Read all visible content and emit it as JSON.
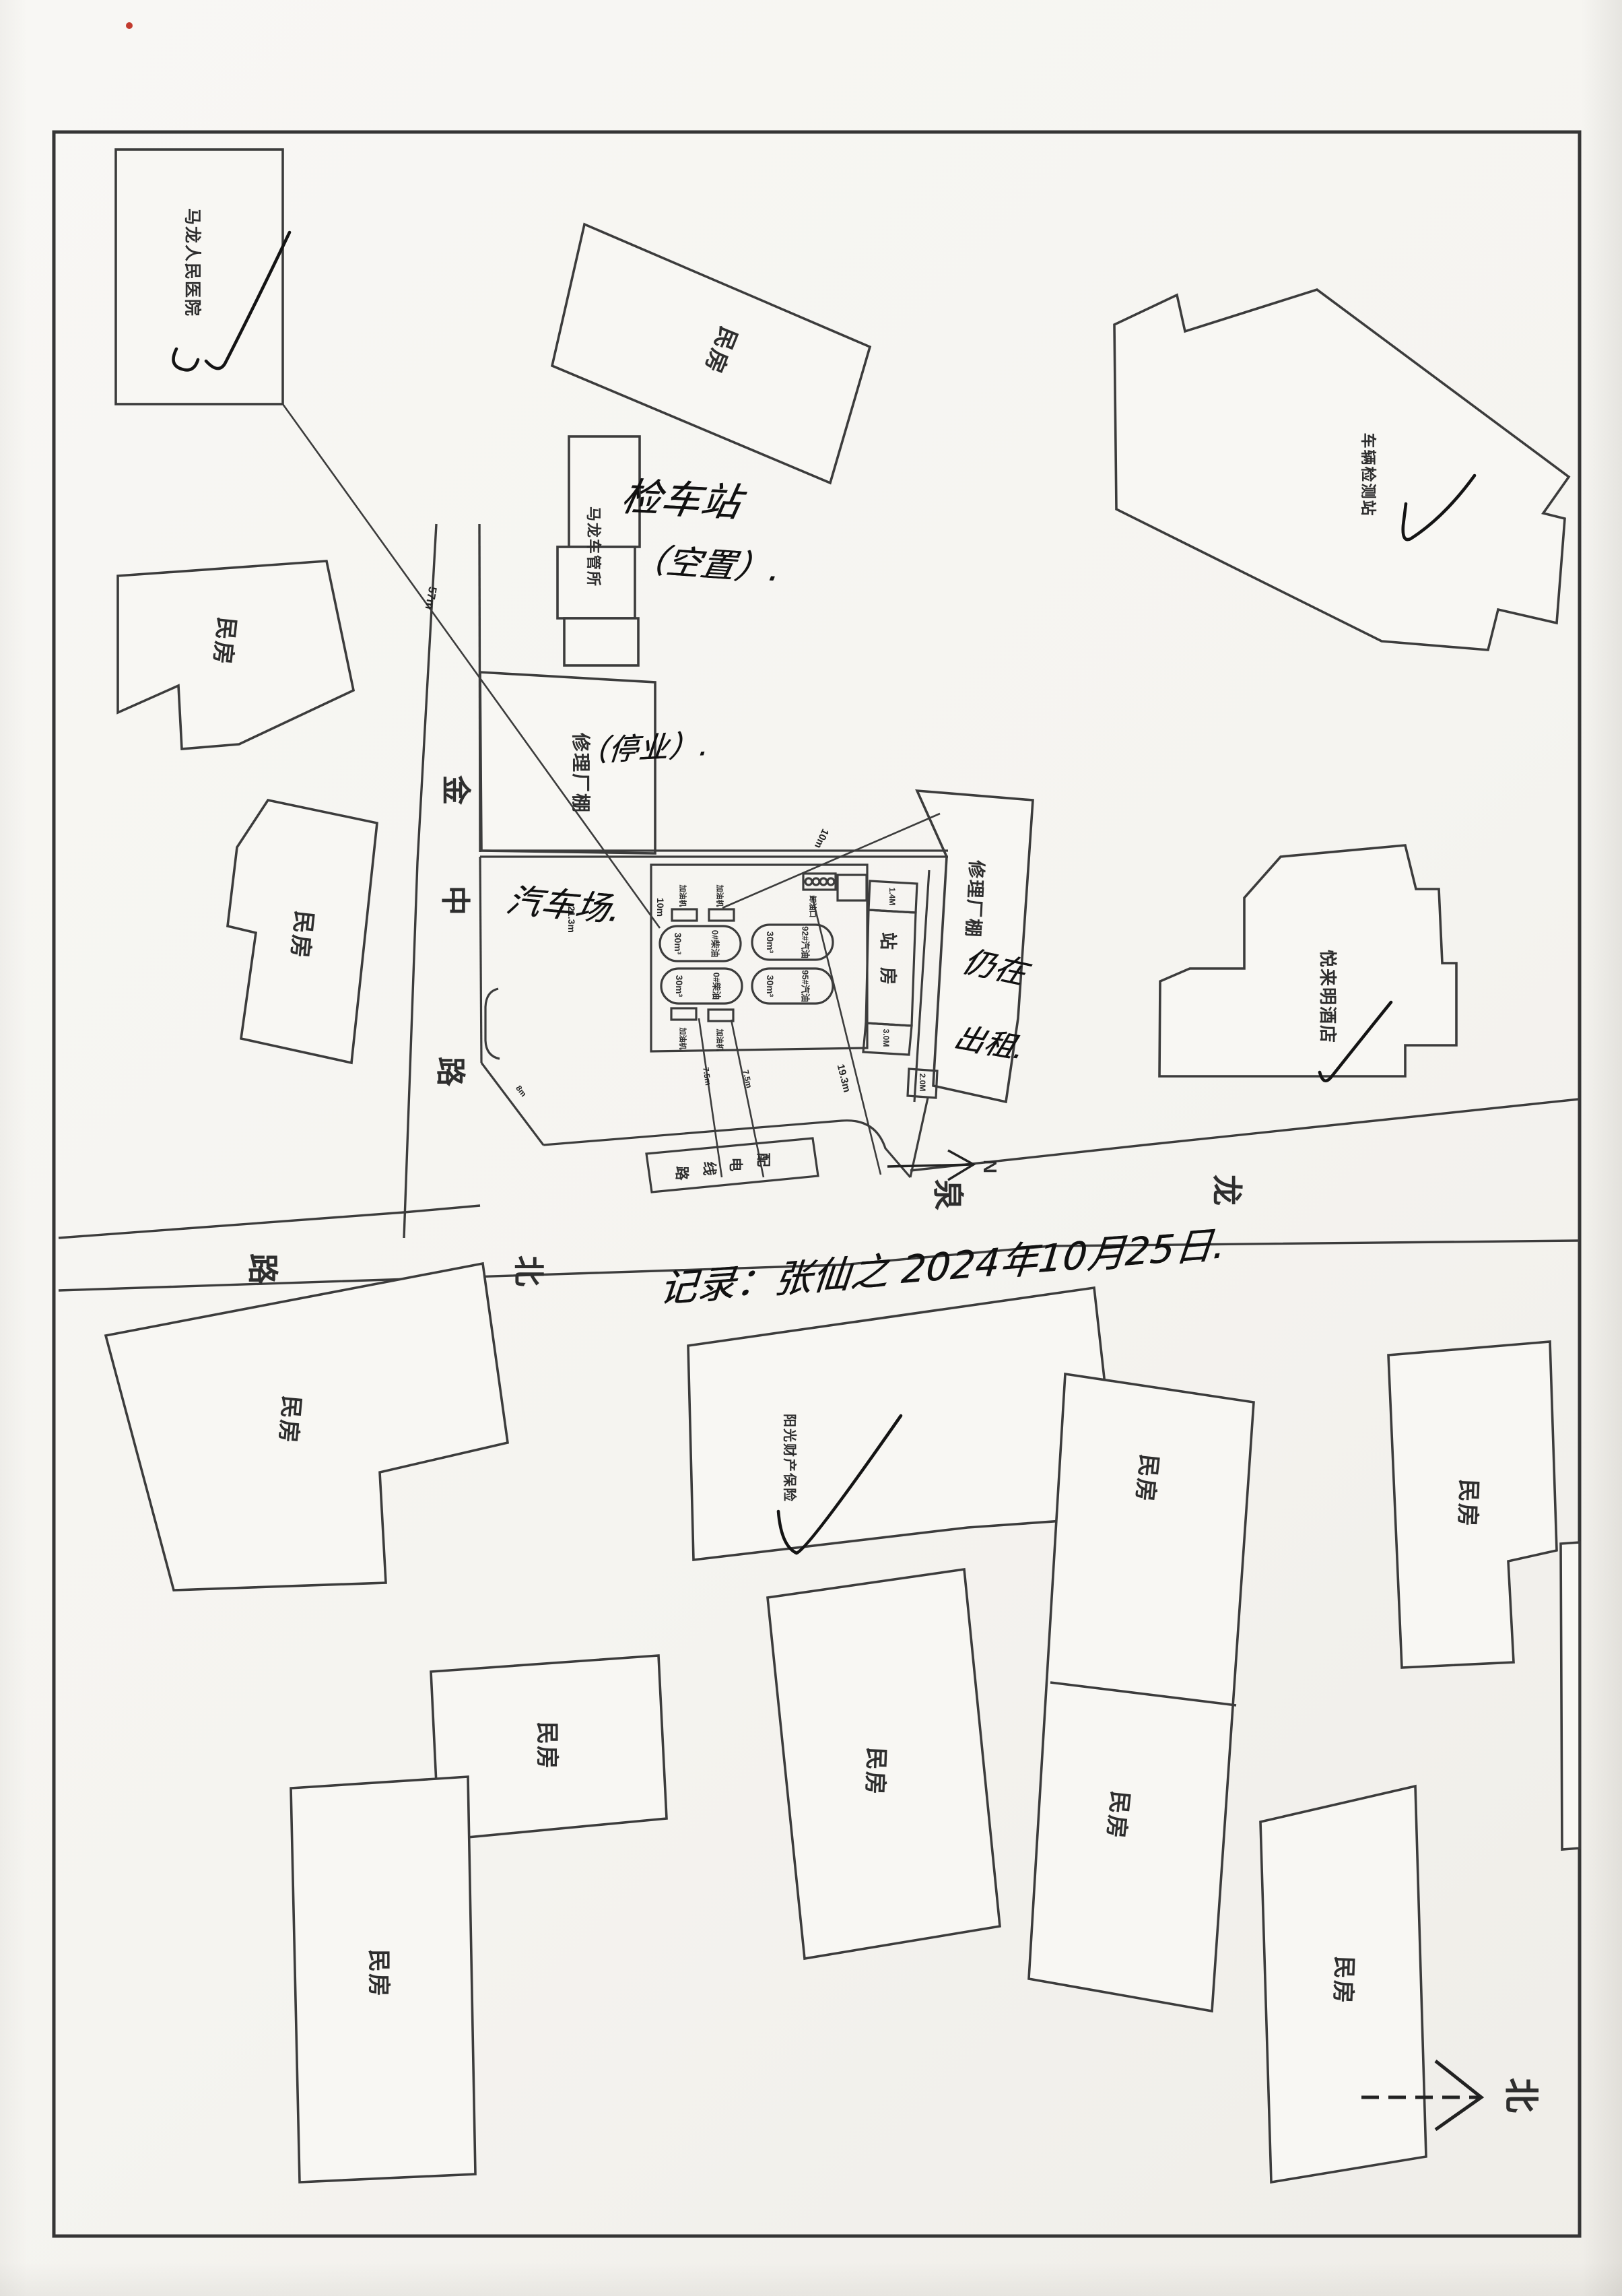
{
  "labels": {
    "hospital": "马龙人民医院",
    "house": "民房",
    "inspection": "车辆检测站",
    "vehicle_admin": "马龙车管所",
    "repair_shed": "修理厂棚",
    "hotel": "悦来明酒店",
    "insurance": "阳光财产保险",
    "station_house": "站房"
  },
  "station": {
    "tanks": [
      {
        "volume": "30m³",
        "product": "0#柴油"
      },
      {
        "volume": "30m³",
        "product": "0#柴油"
      },
      {
        "volume": "30m³",
        "product": "92#汽油"
      },
      {
        "volume": "30m³",
        "product": "95#汽油"
      }
    ],
    "dispenser": "加油机",
    "unloading": "卸油口",
    "rooms": {
      "top": "1.4M",
      "bottom": "3.0M",
      "corner": "2.0M"
    }
  },
  "dims": {
    "hospital_to_tank": "57m",
    "shed_to_unloading": "10m",
    "tank_area_edge": "10m",
    "canopy_depth": "21.3m",
    "to_powerline": "19.3m",
    "dispenser_a": "7.5m",
    "dispenser_b": "7.5m",
    "plot_edge": "8m"
  },
  "roads": {
    "main": {
      "name": "龙泉北路",
      "chars": [
        "龙",
        "泉",
        "北",
        "路"
      ]
    },
    "side": {
      "name": "金中路",
      "chars": [
        "金",
        "中",
        "路"
      ]
    },
    "powerline": {
      "name": "配电线路",
      "chars": [
        "配",
        "电",
        "线",
        "路"
      ]
    }
  },
  "handwriting": {
    "inspection_note_1": "检车站",
    "inspection_note_2": "（空置）.",
    "closed_note": "（停业）.",
    "canopy_note": "汽车场.",
    "rent_note_1": "仍在",
    "rent_note_2": "出租.",
    "record": "记录：张仙之  2024年10月25日."
  },
  "compass": {
    "north_char": "北",
    "north_letter": "N"
  }
}
